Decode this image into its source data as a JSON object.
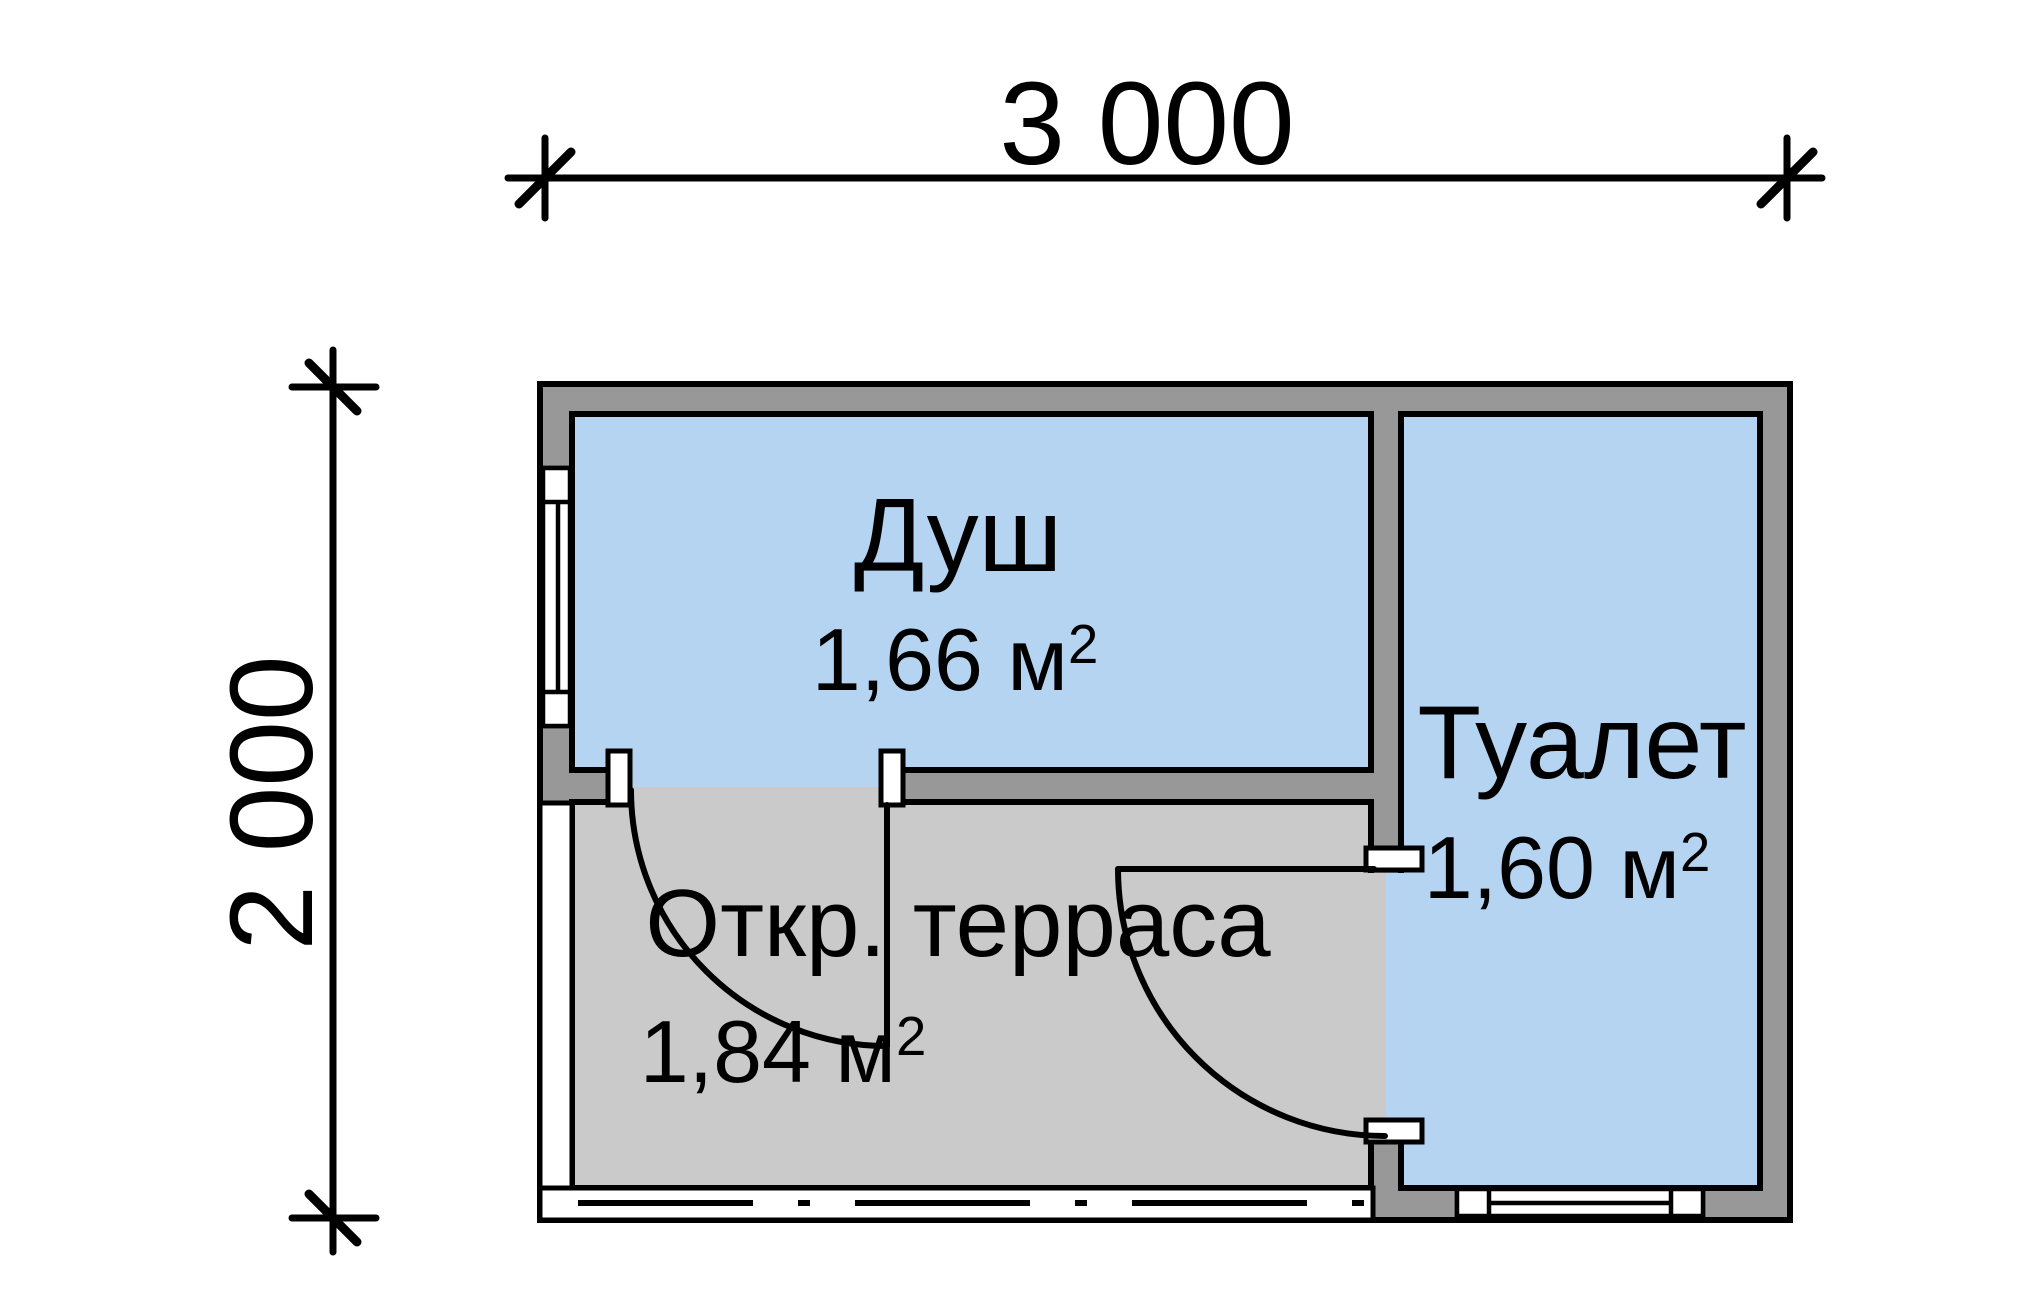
{
  "dimensions": {
    "width_label": "3 000",
    "height_label": "2 000"
  },
  "rooms": {
    "shower": {
      "name": "Душ",
      "area_value": "1,66 м",
      "area_sup": "2"
    },
    "terrace": {
      "name": "Откр. терраса",
      "area_value": "1,84 м",
      "area_sup": "2"
    },
    "toilet": {
      "name": "Туалет",
      "area_value": "1,60 м",
      "area_sup": "2"
    }
  },
  "colors": {
    "room_fill": "#b4d4f2",
    "terrace_fill": "#cacaca",
    "wall_fill": "#989898",
    "line_color": "#000000",
    "window_fill": "#ffffff",
    "background": "#ffffff"
  }
}
